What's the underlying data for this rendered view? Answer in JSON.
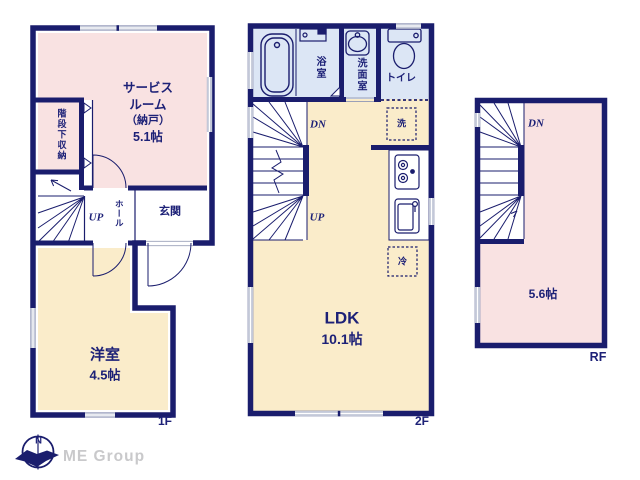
{
  "brand": {
    "name": "ME Group",
    "compass_n": "N"
  },
  "floor1": {
    "label": "1F",
    "service_room_line1": "サービス",
    "service_room_line2": "ルーム",
    "service_room_line3": "（納戸）",
    "service_room_size": "5.1帖",
    "under_stair_storage": "階段下収納",
    "up": "UP",
    "hall": "ホール",
    "entrance": "玄関",
    "western_room": "洋室",
    "western_room_size": "4.5帖"
  },
  "floor2": {
    "label": "2F",
    "bath": "浴室",
    "washroom": "洗面室",
    "toilet": "トイレ",
    "dn": "DN",
    "up": "UP",
    "washer": "洗",
    "fridge": "冷",
    "ldk": "LDK",
    "ldk_size": "10.1帖"
  },
  "roof": {
    "label": "RF",
    "dn": "DN",
    "size": "5.6帖"
  },
  "colors": {
    "wall_navy": "#1a1d6d",
    "text_navy": "#1d2177",
    "room_pink": "#f9e2e2",
    "room_cream": "#faecca",
    "room_blue": "#dce6f5",
    "window_gray": "#c3c8d8",
    "logo_gray": "#c9c9cb"
  }
}
